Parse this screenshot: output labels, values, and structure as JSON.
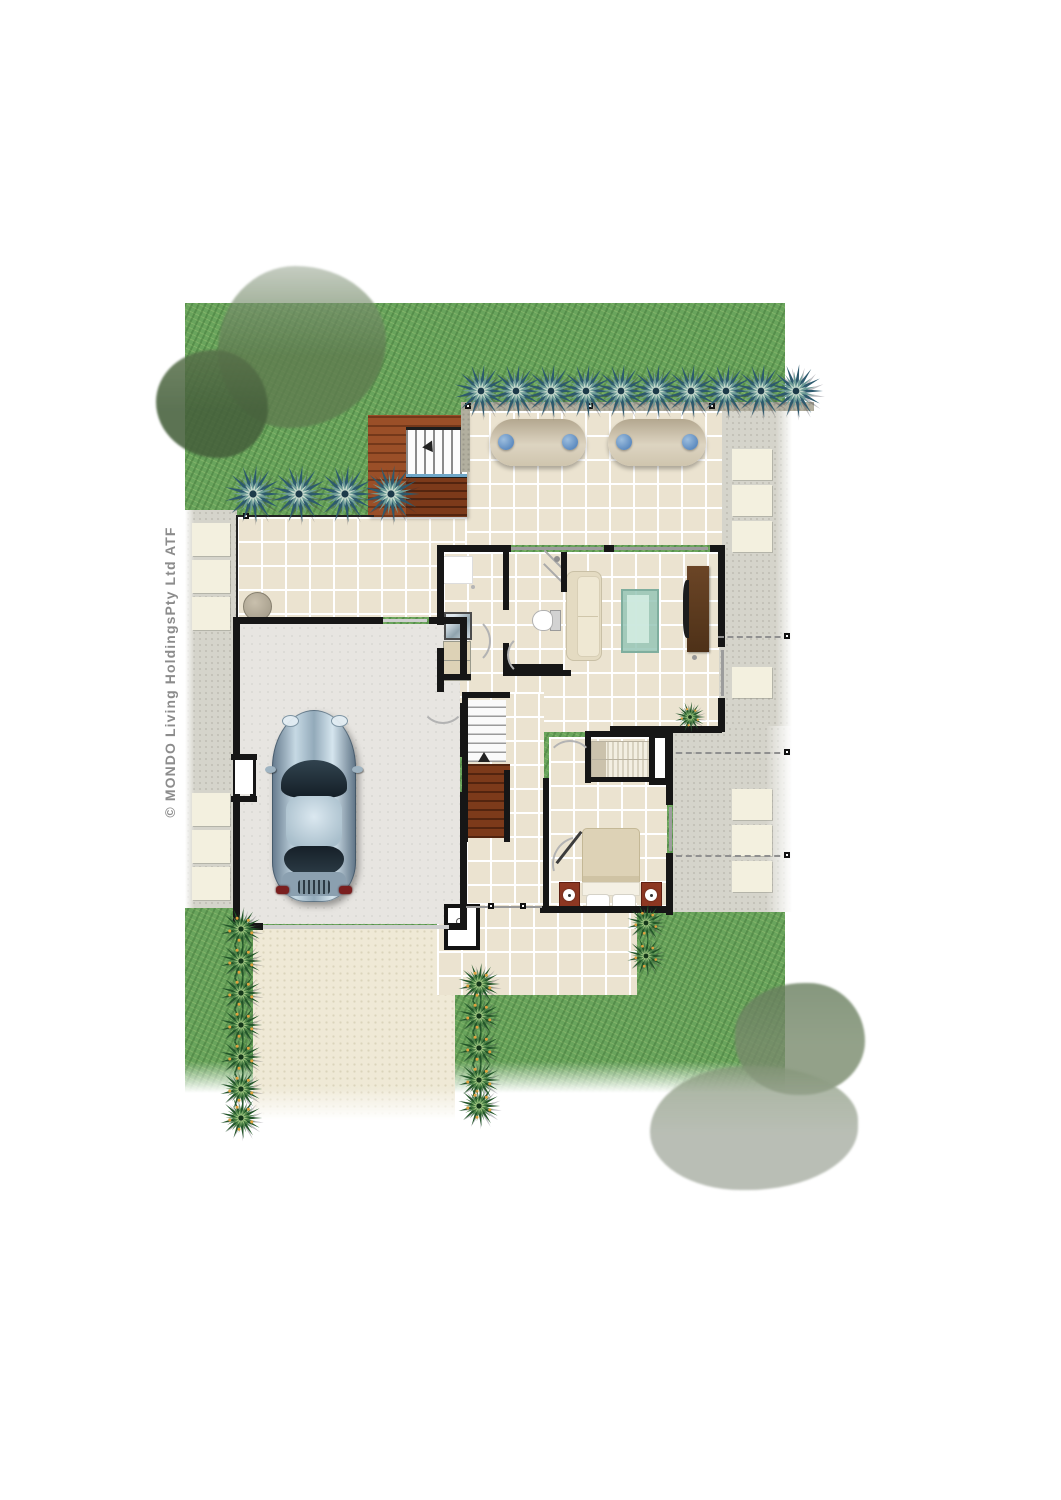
{
  "copyright": "© MONDO Living HoldingsPty Ltd ATF",
  "palette": {
    "lawn": "#69a45c",
    "tile": "#ebe3d0",
    "grout": "#ffffff",
    "wall": "#161616",
    "deck": "#9a4f28",
    "stair_wood": "#7c3a1a",
    "path": "#d5d4cb",
    "stone": "#f3f0df",
    "driveway": "#efe9d6",
    "garage_floor": "#e7e5e1",
    "lounger": "#d7cdb8",
    "pillow_blue": "#5f8cc0",
    "sofa": "#efe8d3",
    "coffee_glass": "#9ec8ba",
    "tv_wood": "#5d3b20",
    "bed": "#ddd2b6",
    "bedside_red": "#8d3722",
    "plant_blue": "#2d5a6e",
    "plant_blue_mid": "#6e9d97",
    "plant_green": "#2a6231",
    "plant_green_mid": "#4b8347",
    "plant_accent": "#e0a13e",
    "car_body": "#9fb7c6",
    "text_gray": "#8c8c8c"
  }
}
